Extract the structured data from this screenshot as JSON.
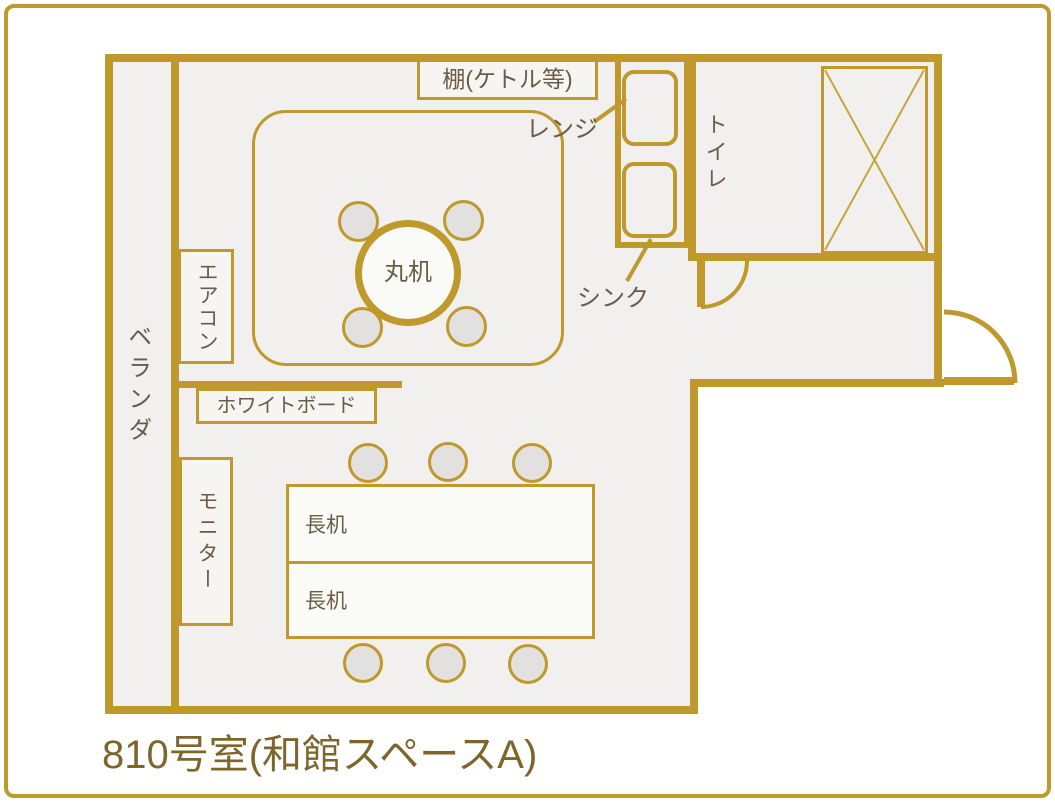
{
  "title": "810号室(和館スペースA)",
  "labels": {
    "shelf": "棚(ケトル等)",
    "microwave": "レンジ",
    "toilet": "トイレ",
    "sink": "シンク",
    "air_conditioner": "エアコン",
    "veranda": "ベランダ",
    "round_table": "丸机",
    "whiteboard": "ホワイトボード",
    "monitor": "モニター",
    "long_table_1": "長机",
    "long_table_2": "長机"
  },
  "colors": {
    "accent_gold": "#bf992c",
    "room_fill": "#f1f0ee",
    "furniture_fill": "#fafaf7",
    "chair_fill": "#e2e1df",
    "label_text": "#6b5c45",
    "title_text": "#7e662a"
  }
}
